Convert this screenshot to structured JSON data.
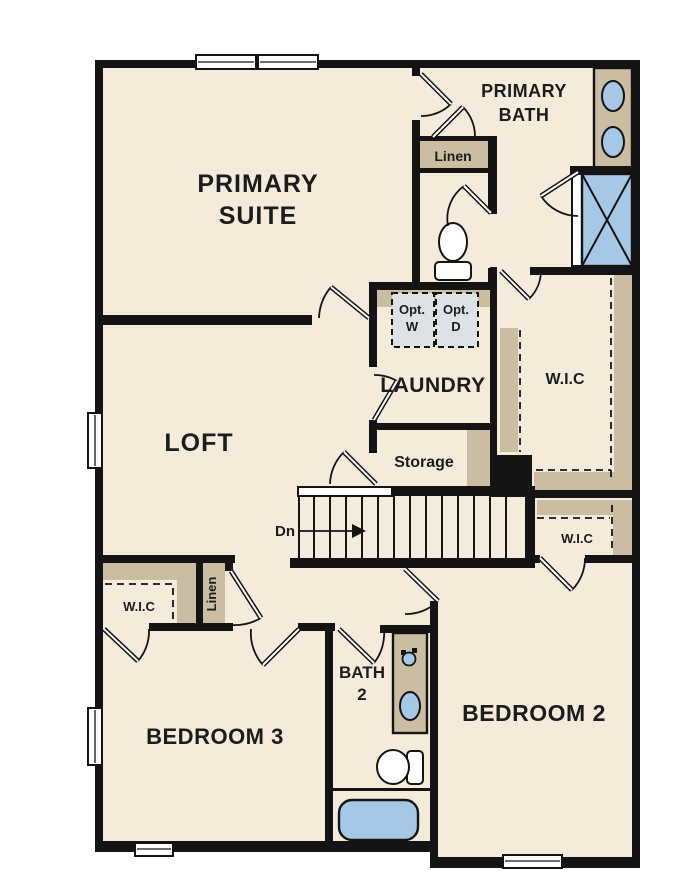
{
  "palette": {
    "background": "#ffffff",
    "floor": "#f4ebda",
    "wall": "#141414",
    "casework_tan": "#cbbda2",
    "fixture_blue": "#a5c8e6",
    "optional_fill": "#dde2e6"
  },
  "rooms": {
    "primary_suite": {
      "line1": "PRIMARY",
      "line2": "SUITE"
    },
    "primary_bath": {
      "line1": "PRIMARY",
      "line2": "BATH"
    },
    "loft": {
      "label": "LOFT"
    },
    "laundry": {
      "label": "LAUNDRY"
    },
    "storage": {
      "label": "Storage"
    },
    "bedroom2": {
      "label": "BEDROOM 2"
    },
    "bedroom3": {
      "label": "BEDROOM 3"
    },
    "bath2": {
      "line1": "BATH",
      "line2": "2"
    },
    "wic_primary": {
      "label": "W.I.C"
    },
    "wic_hall": {
      "label": "W.I.C"
    },
    "wic_bedroom3": {
      "label": "W.I.C"
    }
  },
  "closets": {
    "linen_bath": {
      "label": "Linen"
    },
    "linen_hall": {
      "label": "Linen"
    }
  },
  "appliances": {
    "optional_washer": {
      "line1": "Opt.",
      "line2": "W"
    },
    "optional_dryer": {
      "line1": "Opt.",
      "line2": "D"
    }
  },
  "stairs": {
    "direction_label": "Dn"
  }
}
